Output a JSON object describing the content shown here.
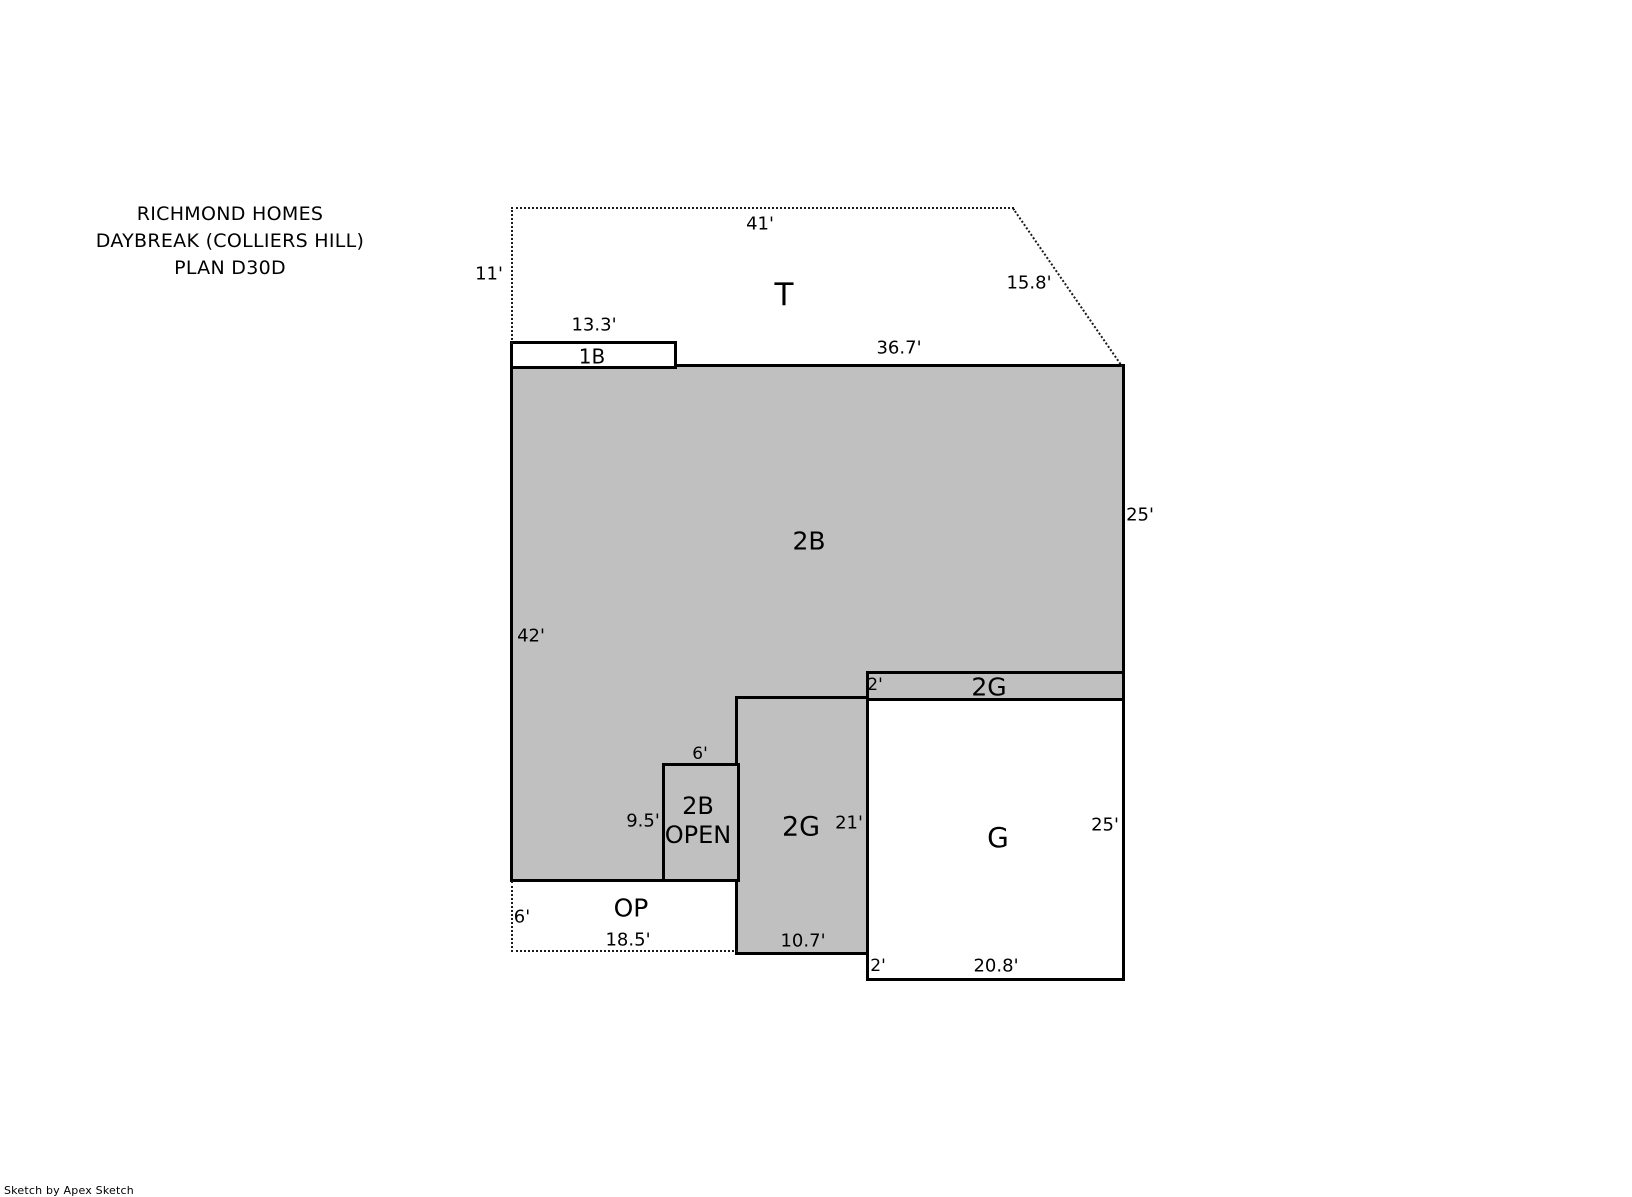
{
  "title": {
    "line1": "RICHMOND HOMES",
    "line2": "DAYBREAK (COLLIERS HILL)",
    "line3": "PLAN D30D"
  },
  "colors": {
    "area_fill": "#C0C0C0",
    "line": "#000000",
    "background": "#FFFFFF"
  },
  "areas": {
    "t": {
      "label": "T",
      "dim_top": "41'",
      "dim_left": "11'",
      "dim_right": "15.8'"
    },
    "b1": {
      "label": "1B",
      "dim_top": "13.3'"
    },
    "b2": {
      "label": "2B",
      "dim_top": "36.7'",
      "dim_left": "42'",
      "dim_right": "25'"
    },
    "g2_strip": {
      "label": "2G",
      "dim_left": "2'"
    },
    "g": {
      "label": "G",
      "dim_right": "25'",
      "dim_bottom": "20.8'",
      "dim_bottom_left": "2'"
    },
    "g2": {
      "label": "2G",
      "dim_right": "21'",
      "dim_bottom": "10.7'"
    },
    "b2_open": {
      "label_line1": "2B",
      "label_line2": "OPEN",
      "dim_top": "6'",
      "dim_left": "9.5'"
    },
    "op": {
      "label": "OP",
      "dim_left": "6'",
      "dim_bottom": "18.5'"
    }
  },
  "footer": {
    "credit": "Sketch by Apex Sketch"
  }
}
